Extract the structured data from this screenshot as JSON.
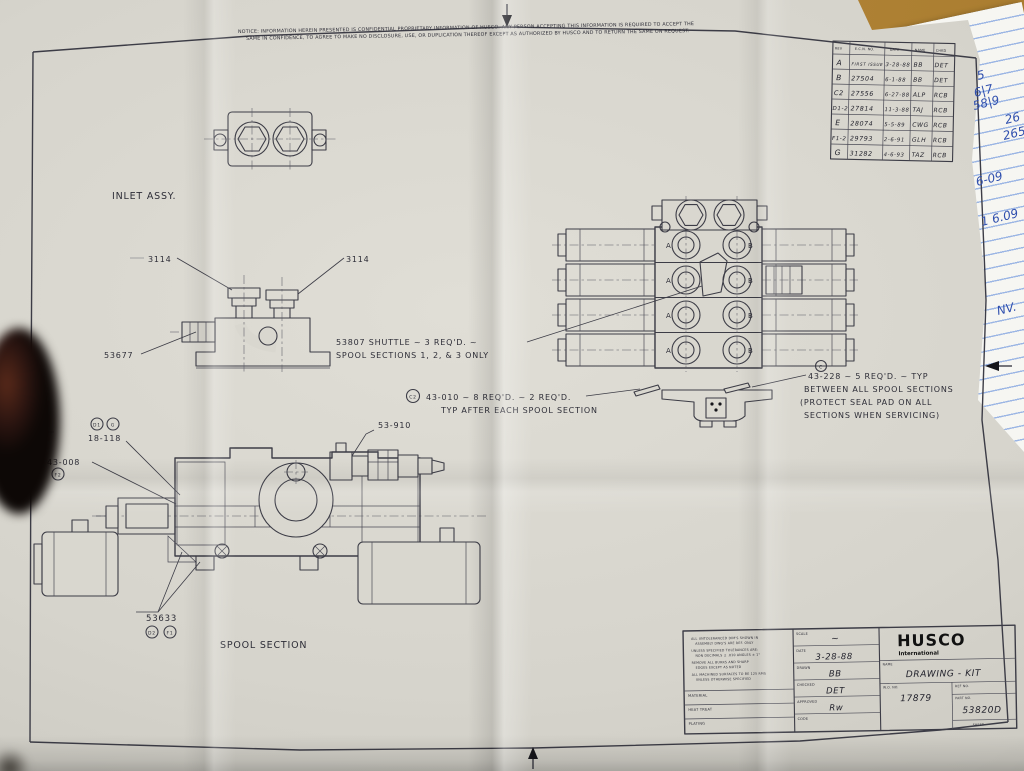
{
  "colors": {
    "paper": "#d6d4cc",
    "ink": "#3c3c46",
    "desk_wood": "#b5883b",
    "notepad_rule": "#9cb6e4",
    "handwriting_blue": "#2f4fae"
  },
  "notice": {
    "line1": "NOTICE:  INFORMATION HEREIN PRESENTED IS CONFIDENTIAL PROPRIETARY INFORMATION OF HUSCO. ANY PERSON ACCEPTING THIS INFORMATION IS REQUIRED TO ACCEPT THE",
    "line2": "SAME IN CONFIDENCE, TO AGREE TO MAKE NO DISCLOSURE, USE, OR DUPLICATION THEREOF EXCEPT AS AUTHORIZED BY HUSCO AND TO RETURN THE SAME ON REQUEST."
  },
  "revision_table": {
    "headers": [
      "REV",
      "E.C.N. NO.",
      "DATE",
      "NAME",
      "CHKD"
    ],
    "rows": [
      [
        "A",
        "FIRST ISSUE",
        "3-28-88",
        "BB",
        "DET"
      ],
      [
        "B",
        "27504",
        "6-1-88",
        "BB",
        "DET"
      ],
      [
        "C2",
        "27556",
        "6-27-88",
        "ALP",
        "RCB"
      ],
      [
        "D1-2",
        "27814",
        "11-3-88",
        "TAJ",
        "RCB"
      ],
      [
        "E",
        "28074",
        "5-5-89",
        "CWG",
        "RCB"
      ],
      [
        "F1-2",
        "29793",
        "2-6-91",
        "GLH",
        "RCB"
      ],
      [
        "G",
        "31282",
        "4-6-93",
        "TAZ",
        "RCB"
      ]
    ]
  },
  "drawing": {
    "labels": {
      "inlet_assy": "INLET ASSY.",
      "spool_section": "SPOOL SECTION",
      "fitting_left": "3114",
      "fitting_right": "3114",
      "inlet_body": "53677",
      "relief_valve": "53-910",
      "seal_18118": "18-118",
      "seal_43008": "43-008",
      "seal_53633": "53633",
      "port_a": "A",
      "port_b": "B"
    },
    "flags": {
      "d1": "D1",
      "g": "G",
      "e": "E",
      "f2": "F2",
      "d2": "D2",
      "f1": "F1",
      "c2": "C2",
      "c": "C"
    },
    "callouts": {
      "shuttle_1": "53807 SHUTTLE ~ 3 REQ'D. ~",
      "shuttle_2": "SPOOL SECTIONS 1, 2, & 3 ONLY",
      "orings_1": "43-010 ~ 8 REQ'D. ~ 2 REQ'D.",
      "orings_2": "TYP AFTER EACH SPOOL SECTION",
      "seals_1": "43-228 ~ 5 REQ'D. ~ TYP",
      "seals_2": "BETWEEN ALL SPOOL SECTIONS",
      "seals_3": "(PROTECT SEAL PAD ON ALL",
      "seals_4": "SECTIONS WHEN SERVICING)"
    }
  },
  "title_block": {
    "company": "HUSCO",
    "company_sub": "International",
    "scale_label": "SCALE",
    "scale_value": "~",
    "date_label": "DATE",
    "date_value": "3-28-88",
    "drawn_label": "DRAWN",
    "drawn_value": "BB",
    "checked_label": "CHECKED",
    "checked_value": "DET",
    "approved_label": "APPROVED",
    "approved_value": "Rw",
    "code_label": "CODE",
    "name_label": "NAME",
    "name_value": "DRAWING - KIT",
    "wo_label": "W.O. NO.",
    "wo_value": "17879",
    "ref_label": "REF NO.",
    "part_label": "PART NO.",
    "part_value": "53820D",
    "sheet_label": "SHEET",
    "material_label": "MATERIAL",
    "heat_label": "HEAT TREAT",
    "plating_label": "PLATING",
    "notes": [
      "ALL UNTOLERANCED DIM'S SHOWN IN",
      "ASSEMBLY DWG'S ARE REF. ONLY",
      "UNLESS SPECIFIED TOLERANCES ARE:",
      "NON DECIMALS ± .010   ANGLES ± 1°",
      "REMOVE ALL BURRS AND SHARP",
      "EDGES EXCEPT AS NOTED",
      "ALL MACHINED SURFACES TO BE 125 RMS",
      "UNLESS OTHERWISE SPECIFIED"
    ]
  },
  "notepad": {
    "fragments": [
      "5",
      "6|7",
      "58|9",
      "26",
      "265",
      "6-09",
      "1 6.09",
      "NV."
    ]
  }
}
